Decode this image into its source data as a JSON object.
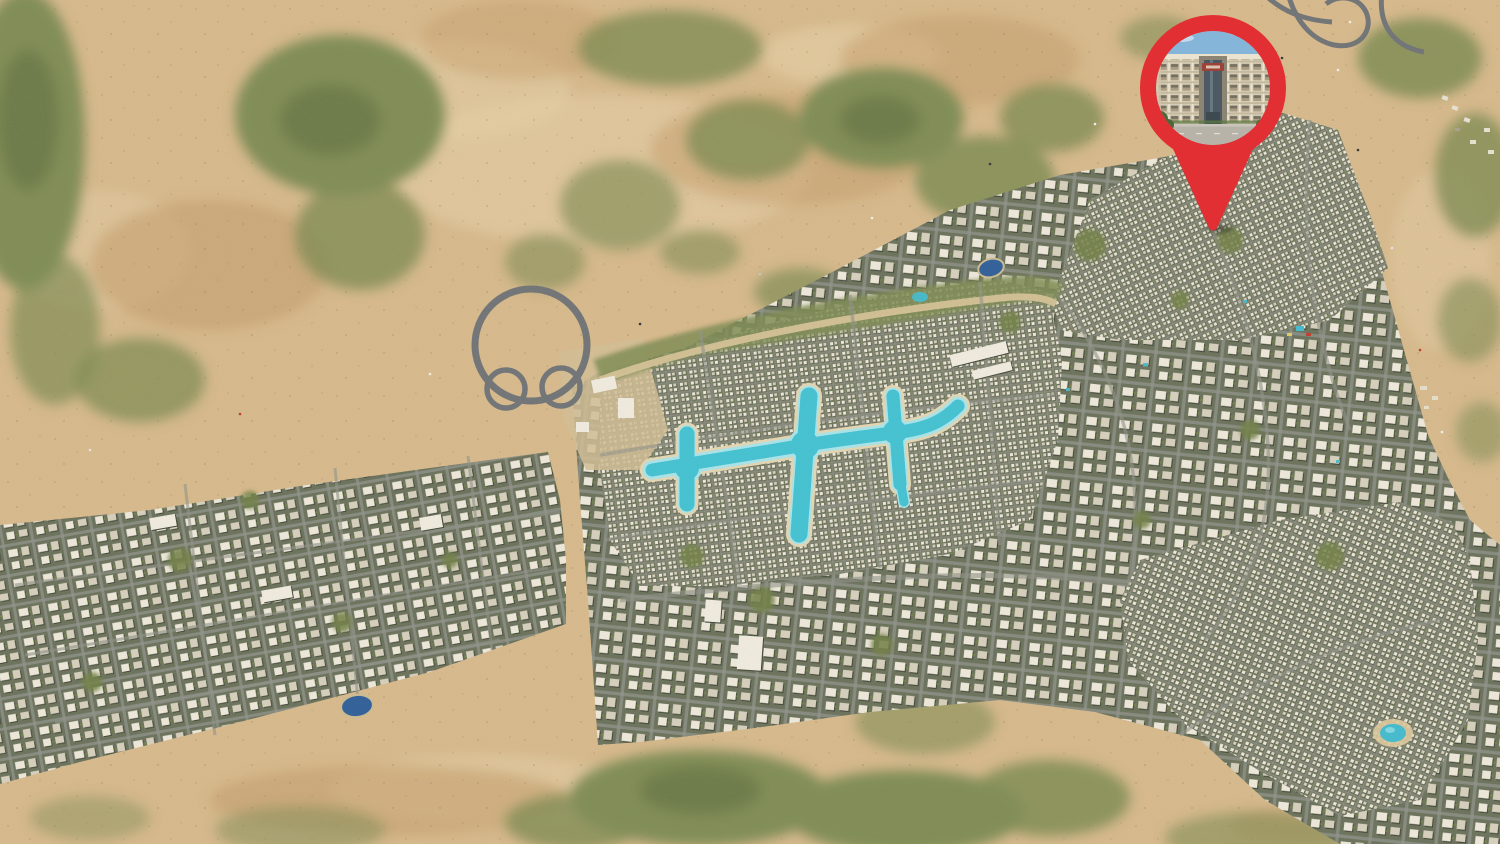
{
  "page": {
    "kind": "aerial-masterplan-map-screenshot"
  },
  "map": {
    "colors": {
      "sand": "#d9bb8d",
      "sandLight": "#e9d3a9",
      "sandDark": "#c29a67",
      "scrub": "#7e8c52",
      "scrubDark": "#55683a",
      "road": "#6e7276",
      "roadLight": "#9a9da0",
      "roadDark": "#4e5256",
      "laneLine": "#c8cbcd",
      "urbanBase": "#68705a",
      "villaBase": "#747b64",
      "streetGray": "#8f928a",
      "bLight": "#f0ecdf",
      "bMid": "#d8d2c0",
      "bShadow": "#3d4335",
      "parkGreen": "#6f8045",
      "treeGreen": "#3f5230",
      "lagoon": "#3fc4d6",
      "lagoonEdge": "#a9e7ee",
      "lagoonRim": "#e7d9b4",
      "pond": "#2b5d9b",
      "pool": "#3fbdd2",
      "pinRed": "#e12f33",
      "sky": "#86b5da",
      "facade": "#d7cdb6",
      "facadeLight": "#eae3d0",
      "facadeShade": "#cfc4ab",
      "window": "#756f60",
      "slab": "#c3b79c",
      "glass": "#4d5a63",
      "tower": "#8d8573",
      "sign": "#9c4238",
      "ground": "#b7b3a9",
      "curb": "#c9c5bb"
    },
    "icons": {
      "location_pin": "map-pin",
      "building_photo": "circular-photo-in-pin"
    }
  }
}
